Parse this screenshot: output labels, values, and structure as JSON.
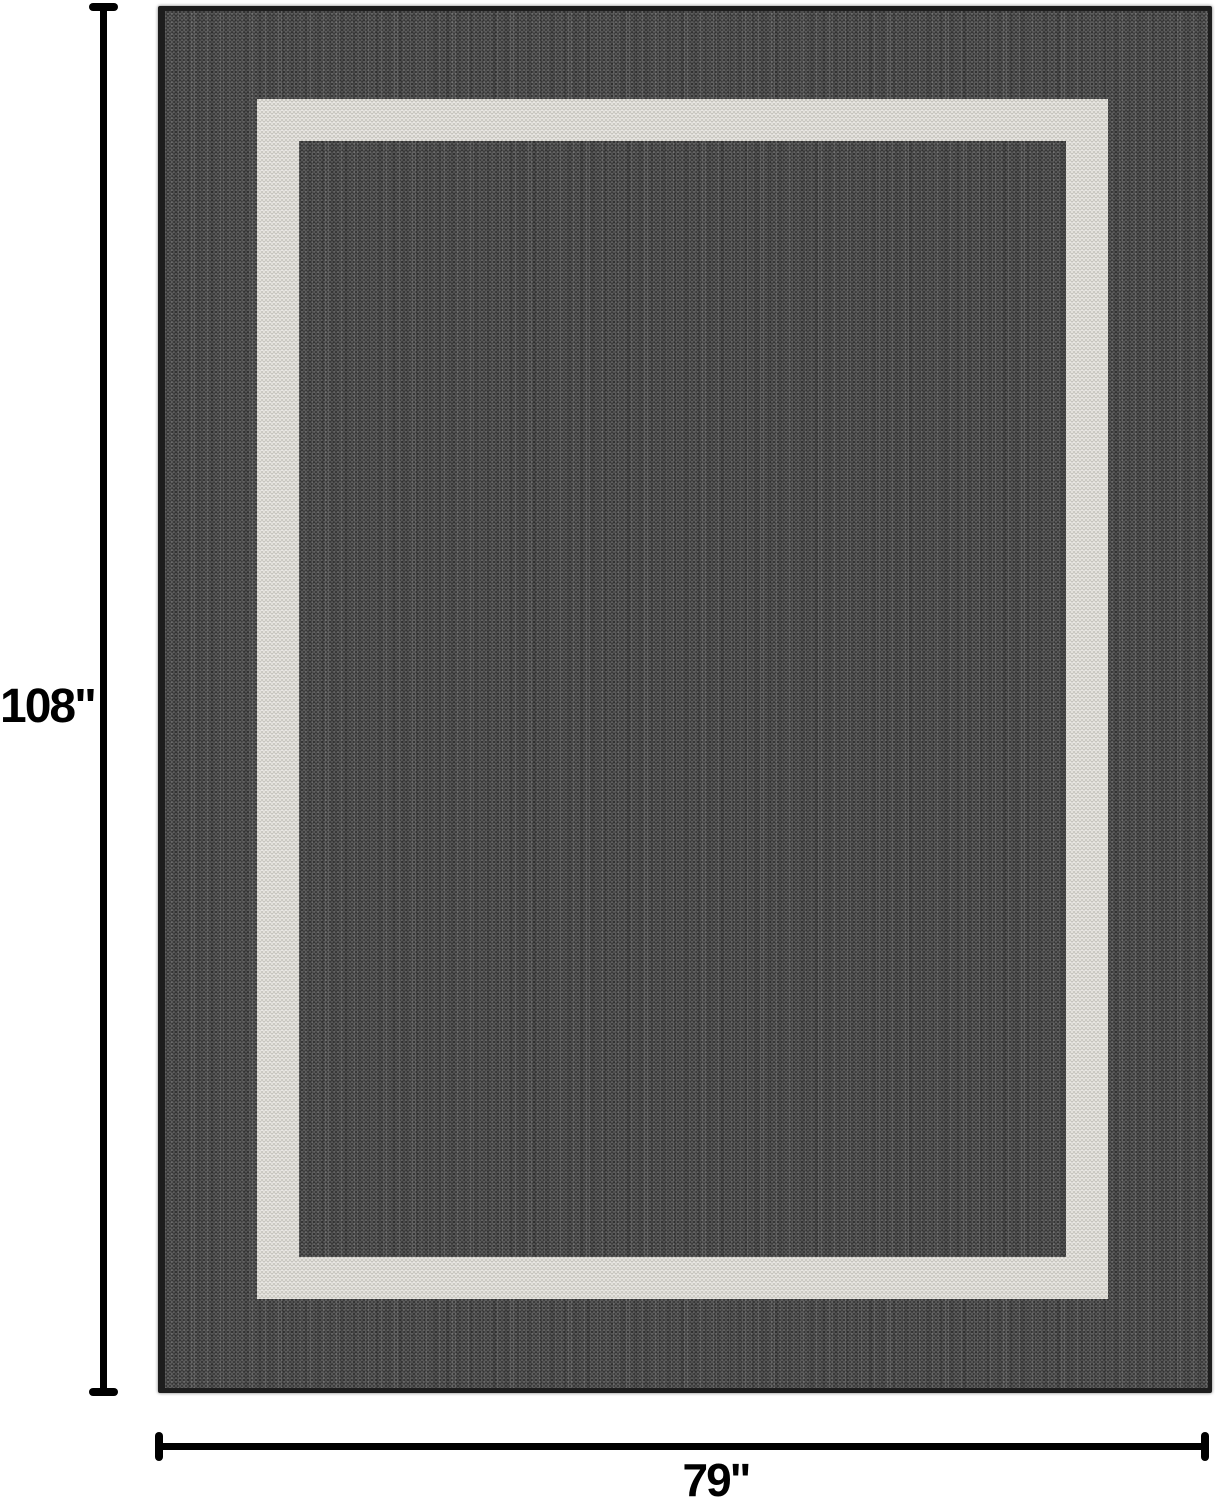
{
  "diagram": {
    "kind": "product-dimension-diagram",
    "subject": "bordered-area-rug"
  },
  "dimensions": {
    "height": {
      "label": "108\""
    },
    "width": {
      "label": "79\""
    }
  },
  "colors": {
    "background": "#ffffff",
    "rug_field": "#4a4a4a",
    "rug_edge_binding": "#1d1d1d",
    "border_stripe": "#d8d6d0",
    "dimension_line": "#000000",
    "label_text": "#000000"
  }
}
